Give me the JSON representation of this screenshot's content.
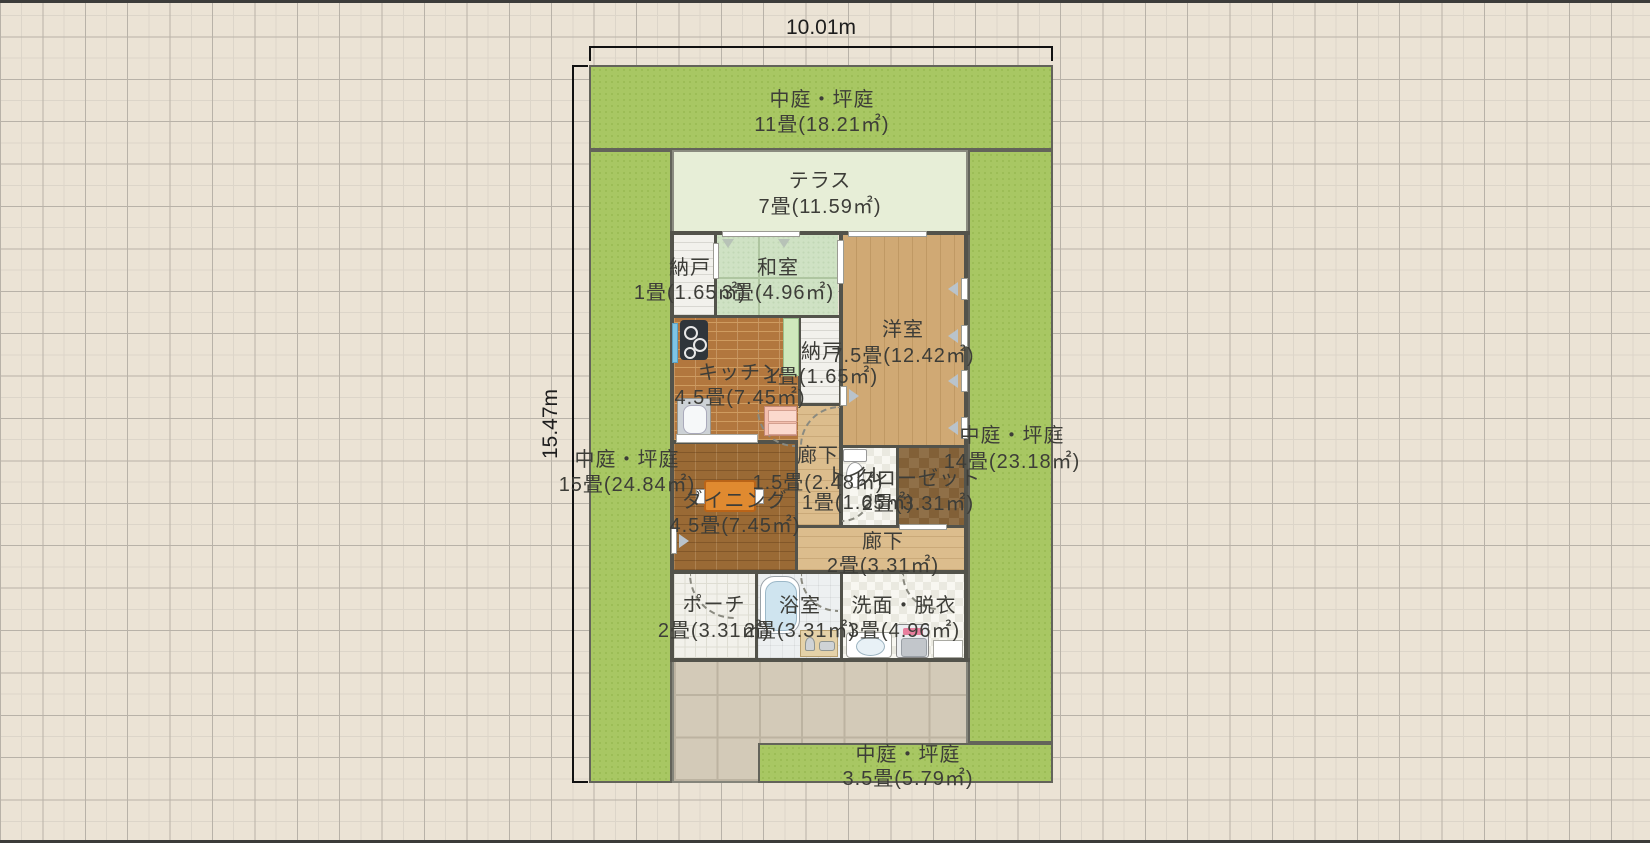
{
  "dimensions": {
    "width_label": "10.01m",
    "height_label": "15.47m"
  },
  "rooms": [
    {
      "id": "niwa-top",
      "name": "中庭・坪庭",
      "area": "11畳(18.21㎡)",
      "cx": 822,
      "y1": 100,
      "y2": 125
    },
    {
      "id": "terrace",
      "name": "テラス",
      "area": "7畳(11.59㎡)",
      "cx": 820,
      "y1": 181,
      "y2": 207
    },
    {
      "id": "nando-1",
      "name": "納戸",
      "area": "1畳(1.65㎡)",
      "cx": 690,
      "y1": 268,
      "y2": 293
    },
    {
      "id": "washitsu",
      "name": "和室",
      "area": "3畳(4.96㎡)",
      "cx": 778,
      "y1": 268,
      "y2": 293
    },
    {
      "id": "youshitsu",
      "name": "洋室",
      "area": "7.5畳(12.42㎡)",
      "cx": 903,
      "y1": 330,
      "y2": 356
    },
    {
      "id": "nando-2",
      "name": "納戸",
      "area": "1畳(1.65㎡)",
      "cx": 822,
      "y1": 352,
      "y2": 377
    },
    {
      "id": "kitchen",
      "name": "キッチン",
      "area": "4.5畳(7.45㎡)",
      "cx": 740,
      "y1": 373,
      "y2": 398
    },
    {
      "id": "niwa-left",
      "name": "中庭・坪庭",
      "area": "15畳(24.84㎡)",
      "cx": 627,
      "y1": 460,
      "y2": 485
    },
    {
      "id": "niwa-right",
      "name": "中庭・坪庭",
      "area": "14畳(23.18㎡)",
      "cx": 1012,
      "y1": 436,
      "y2": 462
    },
    {
      "id": "corridor-1",
      "name": "廊下",
      "area": "1.5畳(2.48㎡)",
      "cx": 818,
      "y1": 456,
      "y2": 483
    },
    {
      "id": "toilet",
      "name": "トイレ",
      "area": "1畳(1.65㎡)",
      "cx": 858,
      "y1": 476,
      "y2": 503
    },
    {
      "id": "closet",
      "name": "クローゼット",
      "area": "2畳(3.31㎡)",
      "cx": 918,
      "y1": 479,
      "y2": 504
    },
    {
      "id": "dining",
      "name": "ダイニング",
      "area": "4.5畳(7.45㎡)",
      "cx": 735,
      "y1": 501,
      "y2": 526
    },
    {
      "id": "corridor-2",
      "name": "廊下",
      "area": "2畳(3.31㎡)",
      "cx": 883,
      "y1": 542,
      "y2": 566
    },
    {
      "id": "porch",
      "name": "ポーチ",
      "area": "2畳(3.31㎡)",
      "cx": 714,
      "y1": 605,
      "y2": 631
    },
    {
      "id": "bath",
      "name": "浴室",
      "area": "2畳(3.31㎡)",
      "cx": 800,
      "y1": 606,
      "y2": 631
    },
    {
      "id": "washroom",
      "name": "洗面・脱衣",
      "area": "3畳(4.96㎡)",
      "cx": 904,
      "y1": 606,
      "y2": 631
    },
    {
      "id": "niwa-bottom",
      "name": "中庭・坪庭",
      "area": "3.5畳(5.79㎡)",
      "cx": 908,
      "y1": 755,
      "y2": 779
    }
  ],
  "colors": {
    "background": "#ebe3d5",
    "garden_green": "#a8c763",
    "terrace_green": "#e7eed7",
    "wall": "#53534b",
    "wood_floor": "#d0a974",
    "dimension_text": "#1d1d1d",
    "label_text": "#3d3d38"
  }
}
